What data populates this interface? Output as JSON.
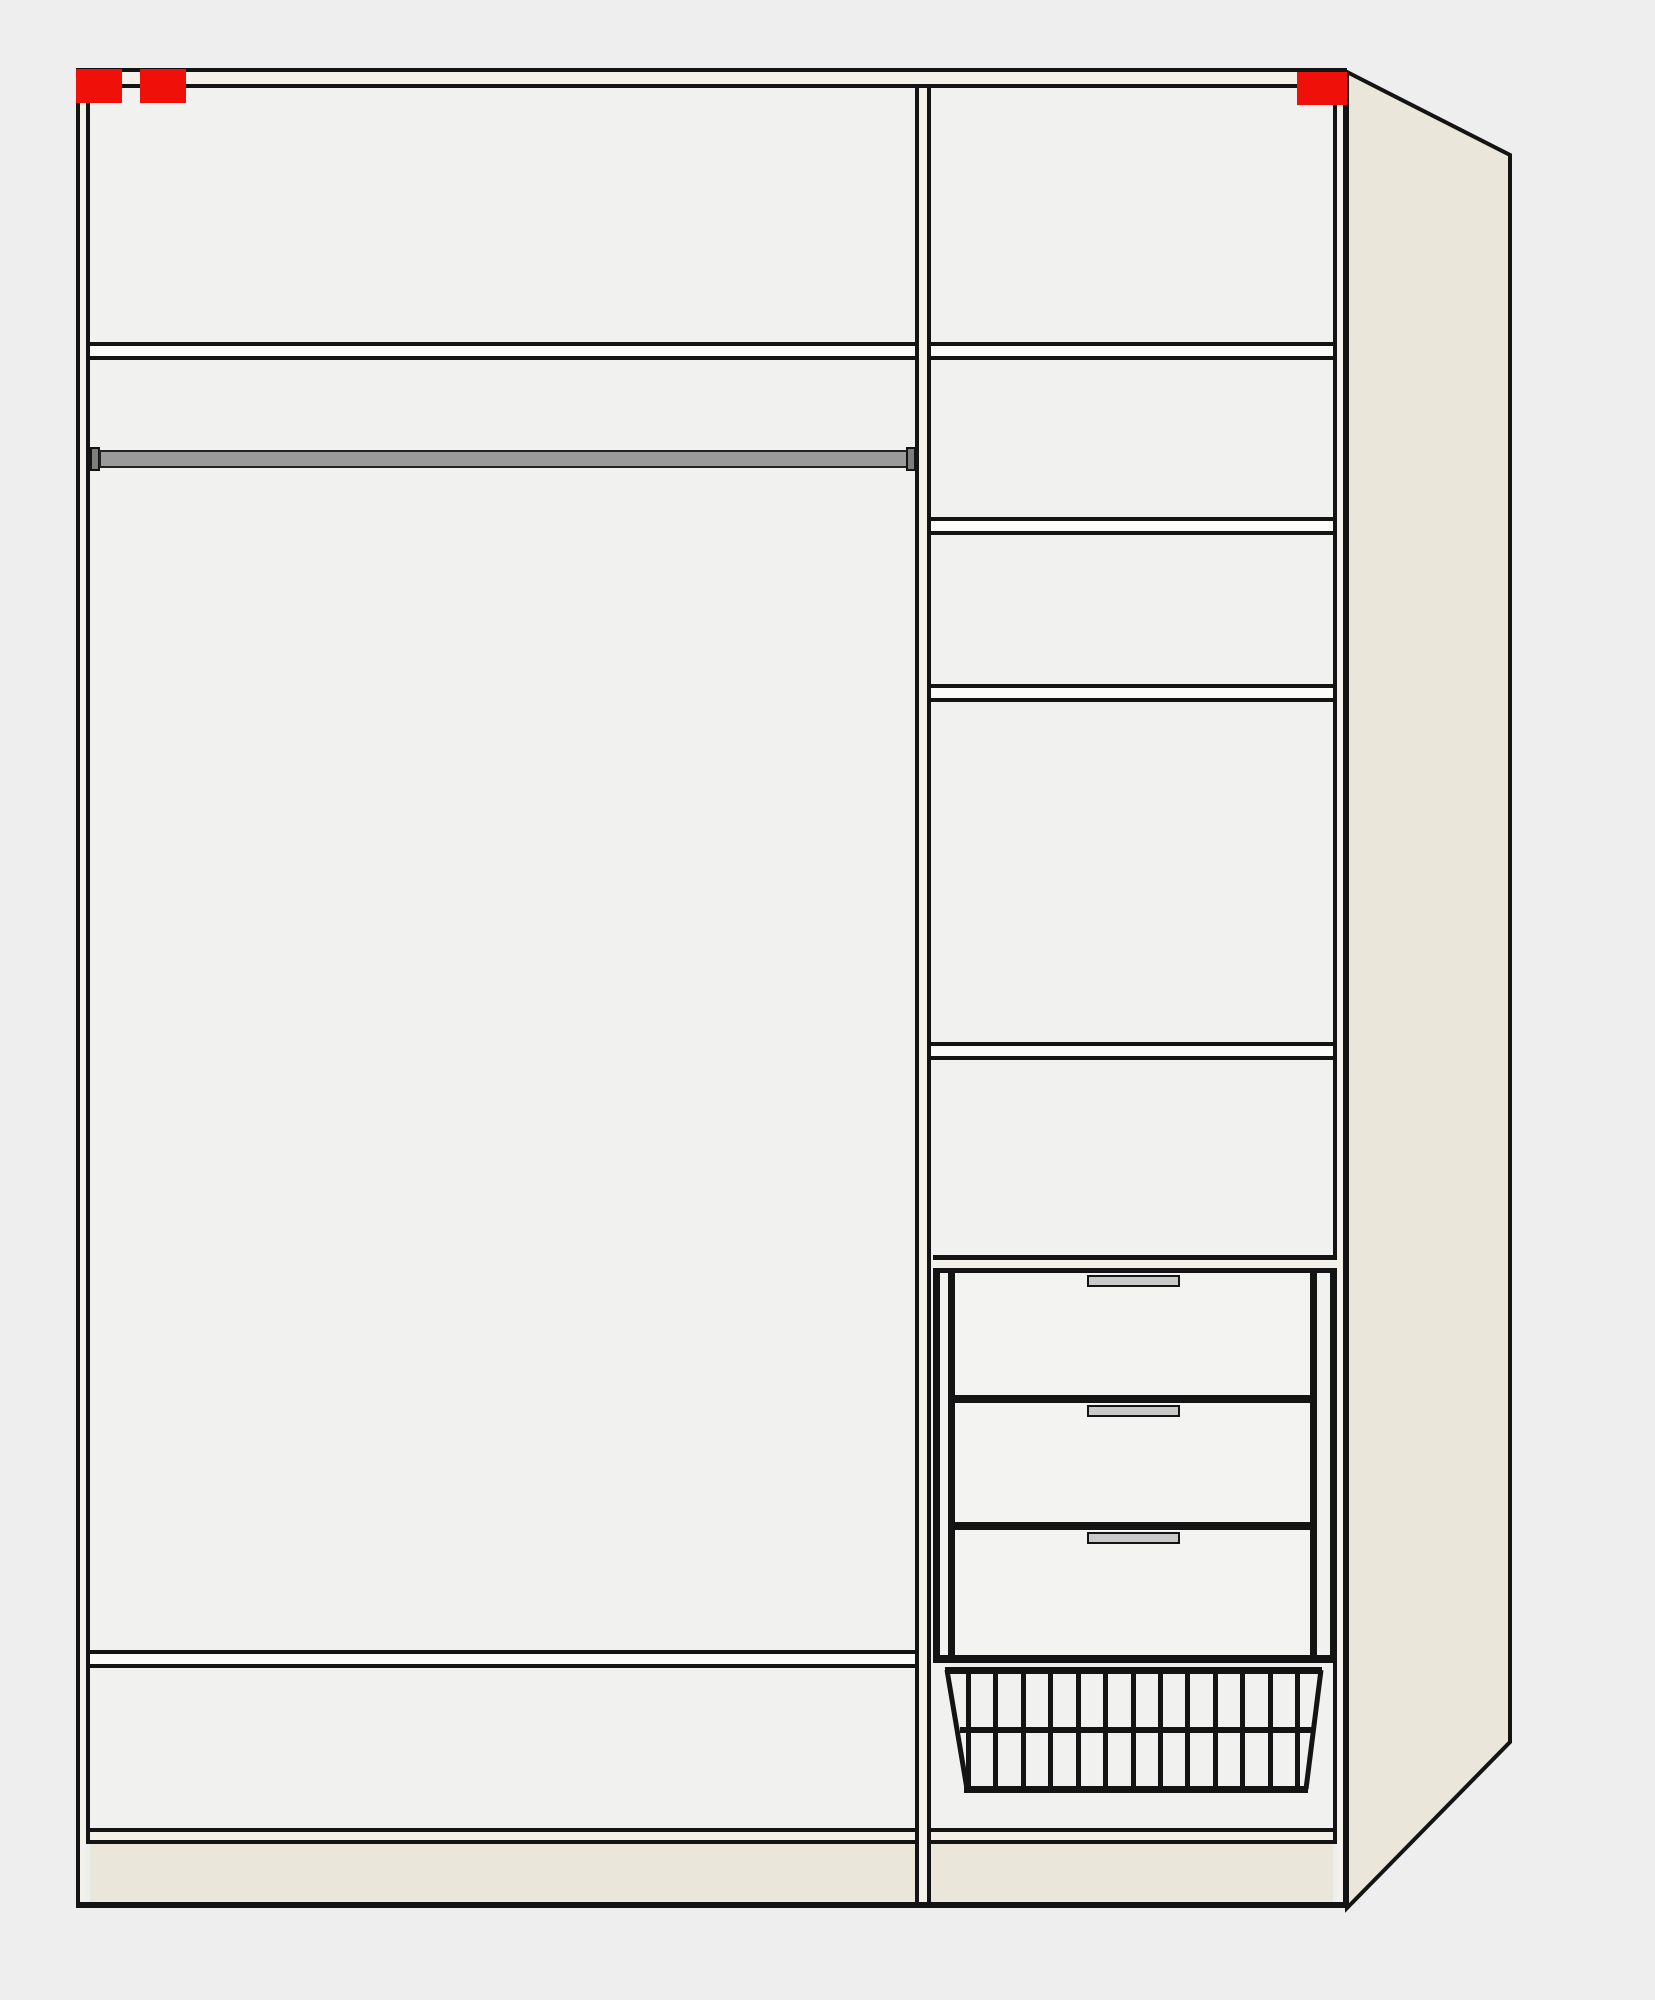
{
  "diagram": {
    "kind": "wardrobe-interior-schematic",
    "sections": 2,
    "left_section": {
      "boards": 2,
      "has_hanging_rod": true
    },
    "right_section": {
      "boards": 4,
      "drawers": 3,
      "has_wire_basket": true
    },
    "markers": {
      "count": 3,
      "color": "#ee1009"
    },
    "basket": {
      "wire_count": 13,
      "horizontal_wires": 1
    }
  },
  "colors": {
    "bg": "#eeeeee",
    "line": "#141414",
    "interior": "#f1f1f0",
    "wall": "#f4f1ea",
    "panel": "#eae6da",
    "board": "#fbfbfa",
    "drawer": "#f3f3f2",
    "rod": "#9a9a9a",
    "rodcap": "#7e7e7e",
    "handle": "#c9c9c9",
    "red": "#ee1009"
  }
}
